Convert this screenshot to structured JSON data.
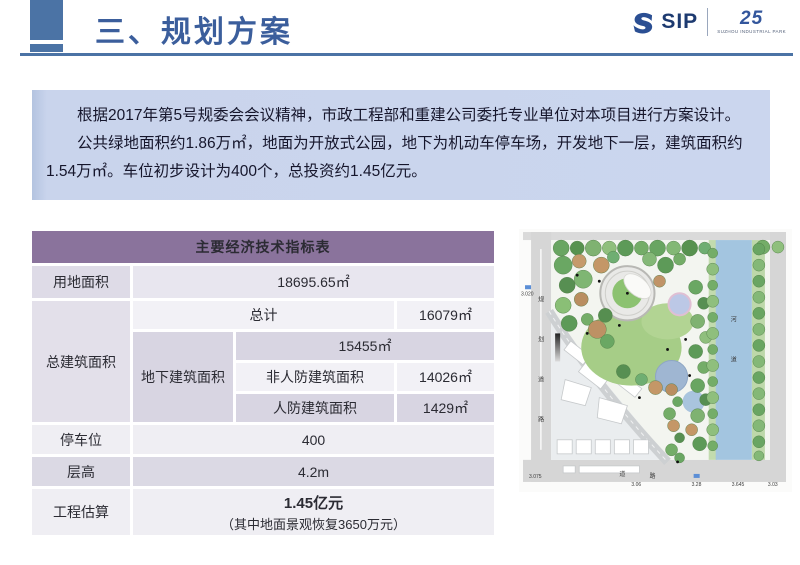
{
  "header": {
    "title": "三、规划方案",
    "accent_color": "#4b73a5",
    "title_color": "#3b5e9c",
    "logo": {
      "text": "SIP",
      "anniversary": "25",
      "tagline": "SUZHOU INDUSTRIAL PARK"
    }
  },
  "intro": {
    "bg_color": "#cbd6ee",
    "paragraphs": [
      "根据2017年第5号规委会会议精神，市政工程部和重建公司委托专业单位对本项目进行方案设计。",
      "公共绿地面积约1.86万㎡，地面为开放式公园，地下为机动车停车场，开发地下一层，建筑面积约1.54万㎡。车位初步设计为400个，总投资约1.45亿元。"
    ]
  },
  "table": {
    "title": "主要经济技术指标表",
    "header_bg": "#8a739c",
    "land_area_label": "用地面积",
    "land_area_value": "18695.65㎡",
    "total_label": "总建筑面积",
    "total_sub_label": "总计",
    "total_sub_value": "16079㎡",
    "underground_label": "地下建筑面积",
    "underground_total": "15455㎡",
    "non_civil_defense_label": "非人防建筑面积",
    "non_civil_defense_value": "14026㎡",
    "civil_defense_label": "人防建筑面积",
    "civil_defense_value": "1429㎡",
    "parking_label": "停车位",
    "parking_value": "400",
    "floor_height_label": "层高",
    "floor_height_value": "4.2m",
    "estimate_label": "工程估算",
    "estimate_value": "1.45亿元",
    "estimate_note": "（其中地面景观恢复3650万元）"
  },
  "site_plan": {
    "left_road_chars": [
      "规",
      "划",
      "道",
      "路"
    ],
    "bottom_road_chars": [
      "道",
      "路"
    ],
    "river_chars": [
      "河",
      "道"
    ],
    "left_elevation": "3.020",
    "elevations": [
      "3.075",
      "3.06",
      "3.28",
      "3.645",
      "3.03"
    ]
  }
}
